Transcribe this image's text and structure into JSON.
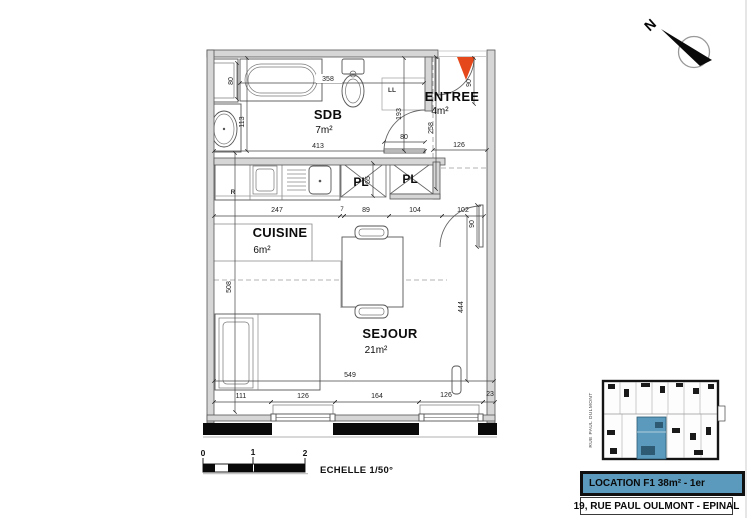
{
  "plan": {
    "rooms": {
      "sdb": {
        "name": "SDB",
        "area": "7m²"
      },
      "entree": {
        "name": "ENTREE",
        "area": "4m²"
      },
      "cuisine": {
        "name": "CUISINE",
        "area": "6m²"
      },
      "sejour": {
        "name": "SEJOUR",
        "area": "21m²"
      }
    },
    "labels": {
      "closet1": "PL",
      "closet2": "PL",
      "washer": "LL",
      "fridge": "R"
    },
    "dims": {
      "d358": "358",
      "d80_tub": "80",
      "d113": "113",
      "d413": "413",
      "d193": "193",
      "d80_door": "80",
      "d258": "258",
      "d90_entry": "90",
      "d126_entree": "126",
      "d247": "247",
      "d7": "7",
      "d89": "89",
      "d104": "104",
      "d102": "102",
      "d65": "65",
      "d90_hall": "90",
      "d508": "508",
      "d444": "444",
      "d549": "549",
      "d111": "111",
      "d126_a": "126",
      "d164": "164",
      "d126_b": "126",
      "d23": "23"
    }
  },
  "scale_bar": {
    "tick0": "0",
    "tick1": "1",
    "tick2": "2",
    "label": "ECHELLE 1/50°"
  },
  "compass": {
    "north_label": "N"
  },
  "site_plan": {
    "street": "RUE PAUL OULMONT",
    "highlight_color": "#5b9abc"
  },
  "title_block": {
    "line1": "LOCATION F1 38m² - 1er",
    "line2": "19, RUE PAUL OULMONT - EPINAL",
    "accent": "#5b9abc"
  },
  "colors": {
    "wall_fill": "#d6d6d6",
    "line": "#3c3c3c",
    "arrow_red": "#e5491b"
  }
}
